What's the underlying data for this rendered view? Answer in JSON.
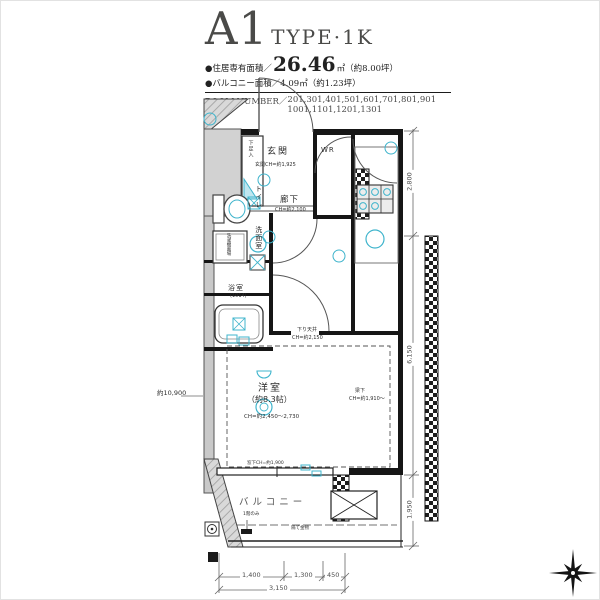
{
  "header": {
    "title": "A1",
    "type_label": "TYPE·1K",
    "bullet": "●",
    "area1_label": "住居専有面積／",
    "area1_value": "26.46",
    "area1_suffix": "㎡（約8.00坪）",
    "area2_label": "バルコニー面積／",
    "area2_value": "4.09",
    "area2_suffix": "㎡（約1.23坪）",
    "room_number_label": "ROOM NUMBER／",
    "room_numbers_line1": "201,301,401,501,601,701,801,901",
    "room_numbers_line2": "1001,1101,1201,1301"
  },
  "plan": {
    "labels": {
      "shoe_cabinet": "下足入",
      "entrance": "玄関",
      "entrance_ch": "玄関CH=約1,925",
      "storage": "WR",
      "toilet": "トイレ",
      "hallway": "廊下",
      "hallway_ch": "CH=約2,100",
      "washroom": "洗面室",
      "laundry": "洗濯機置場",
      "bathroom": "浴室",
      "bathroom_size": "(1014)",
      "drop_ceiling": "下り天井",
      "drop_ceiling_ch": "CH=約2,150",
      "bedroom": "洋室",
      "bedroom_size": "（約8.3帖）",
      "bedroom_ch": "CH=約2,450〜2,730",
      "beam": "梁下",
      "beam_ch": "CH=約1,910〜",
      "window_ch": "窓下CH=約1,900",
      "balcony": "バルコニー",
      "first_floor_only": "1階のみ",
      "partition": "隔て金物",
      "overall_height": "約10,900"
    },
    "dimensions": {
      "bottom": [
        "1,400",
        "1,300",
        "450"
      ],
      "bottom_total": "3,150",
      "right": [
        "2,800",
        "6,150",
        "1,950"
      ]
    },
    "accent_color": "#3fb4cc"
  }
}
